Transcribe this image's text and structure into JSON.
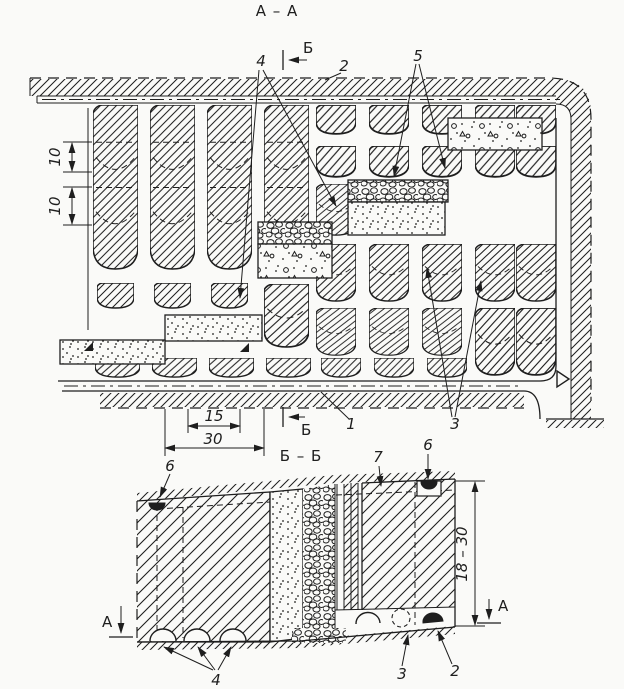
{
  "figure": {
    "ink_color": "#1e1e1e",
    "paper_color": "#fafaf8",
    "plan": {
      "title": "А – А",
      "cut_marker": "Б",
      "callout_1": "1",
      "callout_2": "2",
      "callout_3": "3",
      "callout_4": "4",
      "callout_5": "5",
      "dim_sublevel_upper": "10",
      "dim_sublevel_lower": "10",
      "dim_chamber_width": "15",
      "dim_panel_pitch": "30"
    },
    "section": {
      "title": "Б – Б",
      "cut_marker": "А",
      "callout_2": "2",
      "callout_3": "3",
      "callout_4": "4",
      "callout_6": "6",
      "callout_7": "7",
      "dim_stope_height": "18 – 30"
    }
  }
}
